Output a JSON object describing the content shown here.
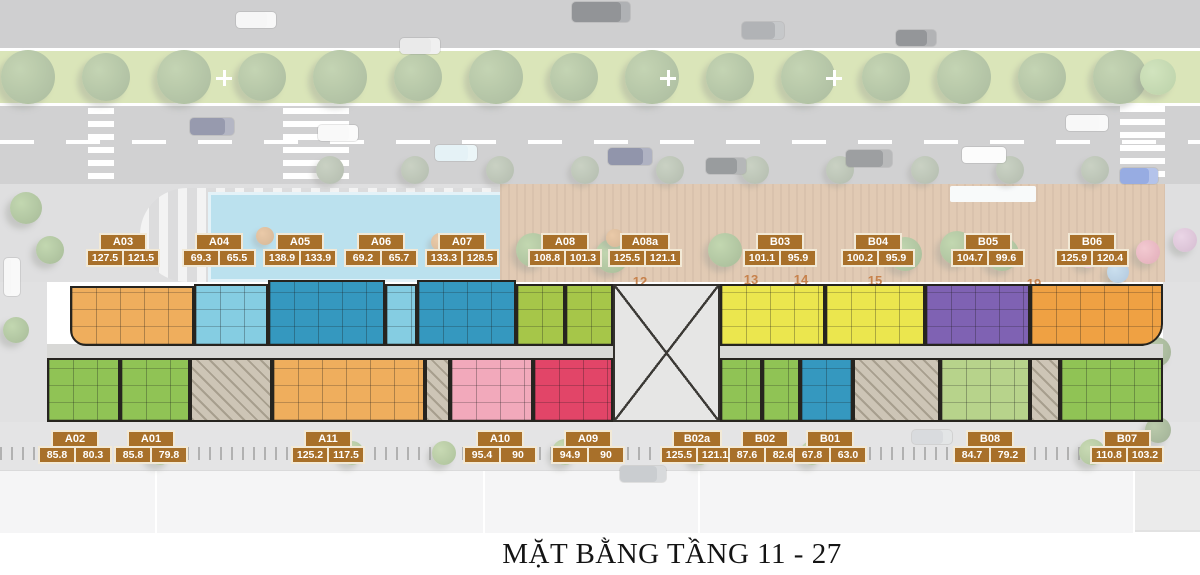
{
  "title": "MẶT BẰNG TẦNG 11 - 27",
  "colors": {
    "badge_bg": "#a8702a",
    "badge_border": "#f2e9d6",
    "orange": "#efae5d",
    "light_blue": "#85cde2",
    "blue": "#3598bf",
    "lime": "#a6c649",
    "green": "#90c355",
    "light_green": "#b7d38b",
    "yellow": "#ebe64e",
    "purple": "#7f62b3",
    "deep_orange": "#efa143",
    "pink": "#f2a9bb",
    "red": "#e24568",
    "core": "#cdc5b6",
    "void": "#e6e6e5",
    "corridor": "#d8d8d6"
  },
  "badges": [
    {
      "id": "A03",
      "areas": [
        "127.5",
        "121.5"
      ],
      "cx": 123,
      "y": 233
    },
    {
      "id": "A04",
      "areas": [
        "69.3",
        "65.5"
      ],
      "cx": 219,
      "y": 233
    },
    {
      "id": "A05",
      "areas": [
        "138.9",
        "133.9"
      ],
      "cx": 300,
      "y": 233
    },
    {
      "id": "A06",
      "areas": [
        "69.2",
        "65.7"
      ],
      "cx": 381,
      "y": 233
    },
    {
      "id": "A07",
      "areas": [
        "133.3",
        "128.5"
      ],
      "cx": 462,
      "y": 233
    },
    {
      "id": "A08",
      "areas": [
        "108.8",
        "101.3"
      ],
      "cx": 565,
      "y": 233
    },
    {
      "id": "A08a",
      "areas": [
        "125.5",
        "121.1"
      ],
      "cx": 645,
      "y": 233
    },
    {
      "id": "B03",
      "areas": [
        "101.1",
        "95.9"
      ],
      "cx": 780,
      "y": 233
    },
    {
      "id": "B04",
      "areas": [
        "100.2",
        "95.9"
      ],
      "cx": 878,
      "y": 233
    },
    {
      "id": "B05",
      "areas": [
        "104.7",
        "99.6"
      ],
      "cx": 988,
      "y": 233
    },
    {
      "id": "B06",
      "areas": [
        "125.9",
        "120.4"
      ],
      "cx": 1092,
      "y": 233
    },
    {
      "id": "A02",
      "areas": [
        "85.8",
        "80.3"
      ],
      "cx": 75,
      "y": 430
    },
    {
      "id": "A01",
      "areas": [
        "85.8",
        "79.8"
      ],
      "cx": 151,
      "y": 430
    },
    {
      "id": "A11",
      "areas": [
        "125.2",
        "117.5"
      ],
      "cx": 328,
      "y": 430
    },
    {
      "id": "A10",
      "areas": [
        "95.4",
        "90"
      ],
      "cx": 500,
      "y": 430
    },
    {
      "id": "A09",
      "areas": [
        "94.9",
        "90"
      ],
      "cx": 588,
      "y": 430
    },
    {
      "id": "B02a",
      "areas": [
        "125.5",
        "121.1"
      ],
      "cx": 697,
      "y": 430
    },
    {
      "id": "B02",
      "areas": [
        "87.6",
        "82.6"
      ],
      "cx": 765,
      "y": 430
    },
    {
      "id": "B01",
      "areas": [
        "67.8",
        "63.0"
      ],
      "cx": 830,
      "y": 430
    },
    {
      "id": "B08",
      "areas": [
        "84.7",
        "79.2"
      ],
      "cx": 990,
      "y": 430
    },
    {
      "id": "B07",
      "areas": [
        "110.8",
        "103.2"
      ],
      "cx": 1127,
      "y": 430
    }
  ],
  "plan_units": [
    {
      "id": "A03",
      "c": "orange",
      "x": 70,
      "y": 286,
      "w": 124,
      "h": 60,
      "br": "0 0 0 16px"
    },
    {
      "id": "A04",
      "c": "light_blue",
      "x": 194,
      "y": 284,
      "w": 74,
      "h": 62
    },
    {
      "id": "A05",
      "c": "blue",
      "x": 268,
      "y": 280,
      "w": 117,
      "h": 66
    },
    {
      "id": "A06",
      "c": "light_blue",
      "x": 385,
      "y": 284,
      "w": 32,
      "h": 62
    },
    {
      "id": "A07",
      "c": "blue",
      "x": 417,
      "y": 280,
      "w": 99,
      "h": 66
    },
    {
      "id": "A08",
      "c": "lime",
      "x": 516,
      "y": 284,
      "w": 49,
      "h": 62
    },
    {
      "id": "A08a",
      "c": "lime",
      "x": 565,
      "y": 284,
      "w": 48,
      "h": 62
    },
    {
      "id": "B03",
      "c": "yellow",
      "x": 720,
      "y": 284,
      "w": 105,
      "h": 62
    },
    {
      "id": "B04",
      "c": "yellow",
      "x": 825,
      "y": 284,
      "w": 100,
      "h": 62
    },
    {
      "id": "B05",
      "c": "purple",
      "x": 925,
      "y": 284,
      "w": 105,
      "h": 62
    },
    {
      "id": "B06",
      "c": "deep_orange",
      "x": 1030,
      "y": 284,
      "w": 133,
      "h": 62,
      "br": "0 0 22px 0"
    },
    {
      "id": "A02",
      "c": "green",
      "x": 47,
      "y": 358,
      "w": 73,
      "h": 64
    },
    {
      "id": "A01",
      "c": "green",
      "x": 120,
      "y": 358,
      "w": 70,
      "h": 64
    },
    {
      "id": "A11",
      "c": "orange",
      "x": 272,
      "y": 358,
      "w": 153,
      "h": 64
    },
    {
      "id": "A10",
      "c": "pink",
      "x": 450,
      "y": 358,
      "w": 83,
      "h": 64
    },
    {
      "id": "A09",
      "c": "red",
      "x": 533,
      "y": 358,
      "w": 80,
      "h": 64
    },
    {
      "id": "B02a",
      "c": "green",
      "x": 720,
      "y": 358,
      "w": 42,
      "h": 64
    },
    {
      "id": "B02",
      "c": "green",
      "x": 762,
      "y": 358,
      "w": 38,
      "h": 64
    },
    {
      "id": "B01",
      "c": "blue",
      "x": 800,
      "y": 358,
      "w": 53,
      "h": 64
    },
    {
      "id": "B08",
      "c": "light_green",
      "x": 940,
      "y": 358,
      "w": 90,
      "h": 64
    },
    {
      "id": "B07",
      "c": "green",
      "x": 1060,
      "y": 358,
      "w": 103,
      "h": 64
    }
  ],
  "grid_numbers": [
    {
      "label": "8",
      "x": 534,
      "y": 250
    },
    {
      "label": "12",
      "x": 640,
      "y": 274
    },
    {
      "label": "13",
      "x": 751,
      "y": 272
    },
    {
      "label": "14",
      "x": 801,
      "y": 272
    },
    {
      "label": "15",
      "x": 875,
      "y": 273
    },
    {
      "label": "19",
      "x": 1034,
      "y": 276
    }
  ]
}
